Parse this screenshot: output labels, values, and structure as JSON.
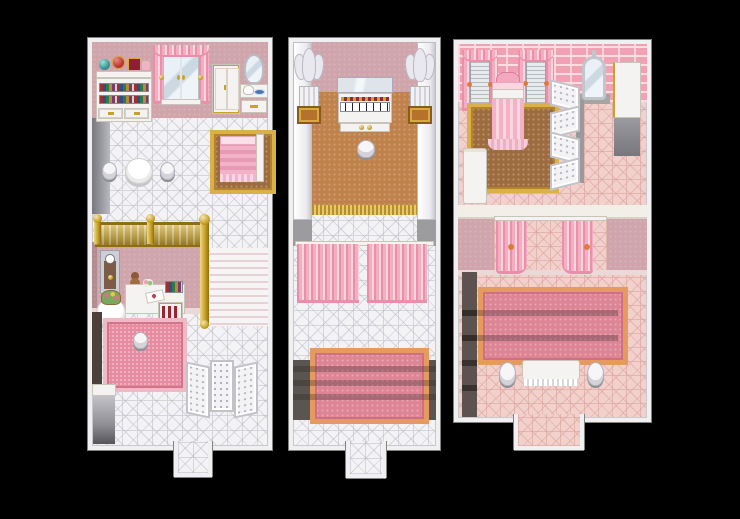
{
  "scene": {
    "type": "game-map-screenshot",
    "style": "top-down RPG interior rooms (RPG Maker style)",
    "panel_count": 3,
    "background": "#000000"
  },
  "palette": {
    "bg": "#000000",
    "panel_border": "#f0f0f2",
    "panel_outline": "#82827f",
    "wall_mauve": "#cfa4ab",
    "skirting": "#ead9d6",
    "tile_white": "#f3f3f5",
    "tile_pink": "#f2d0cc",
    "brick": "#f0a2b2",
    "brick_mortar": "#fbdde2",
    "carpet_orange": "#c0824c",
    "carpet_brown": "#9c6b40",
    "gold": "#c9a227",
    "gold_lace": "#d9b04a",
    "curtain_pink": "#f4aec1",
    "curtain_light": "#fbd6e0",
    "curtain_dark": "#e98fa9",
    "rug_pink": "#dd8495",
    "rug_border": "#e59a5f",
    "left_rug": "#e68ba0",
    "left_rug_border": "#efb9c5",
    "stairs_white": "#f6f4f4",
    "stairs_line": "#e4d2d5",
    "dark_stair": "#5a5550",
    "gray_wall": "#9c9c9e",
    "white_furniture": "#f4f3f1"
  },
  "panels": [
    {
      "name": "dressing-room-two-level",
      "position": "left",
      "levels": [
        "upper bedroom with tea table",
        "lower study reached by staircase"
      ],
      "objects": [
        "gift shelf with teal box, red ornament and crimson gift",
        "white bookshelf with colored books and drawers",
        "mirrored double window with pink curtains",
        "white wardrobe",
        "vanity with oval mirror and tea set",
        "single pink bed on brown-gold carpet",
        "round white table",
        "two stools",
        "gold balcony railing",
        "white staircase",
        "grandfather clock",
        "writing desk with teddy bear and books",
        "wine rack",
        "round table with flower basket",
        "pink rug with stool",
        "three-panel folding screen",
        "gray cabinet",
        "south exit"
      ]
    },
    {
      "name": "music-hall",
      "position": "center",
      "objects": [
        "angel statue on column (left)",
        "angel statue on column (right)",
        "white upright piano",
        "piano stool",
        "orange carpet with gold fringe",
        "marble pilasters",
        "pink curtain divider",
        "descending steps",
        "pink rug with orange border",
        "south exit"
      ]
    },
    {
      "name": "grand-bedroom",
      "position": "right",
      "objects": [
        "pink brick wall",
        "two shuttered windows with pink curtains",
        "canopy bed with crown",
        "brown-gold carpet",
        "standing mirror",
        "zigzag folding screen",
        "white wardrobe with open lower half",
        "white console table",
        "curtained alcove",
        "dark stairwell",
        "large pink rug with orange border",
        "dressing table with white cloth",
        "two stools",
        "south exit"
      ]
    }
  ]
}
